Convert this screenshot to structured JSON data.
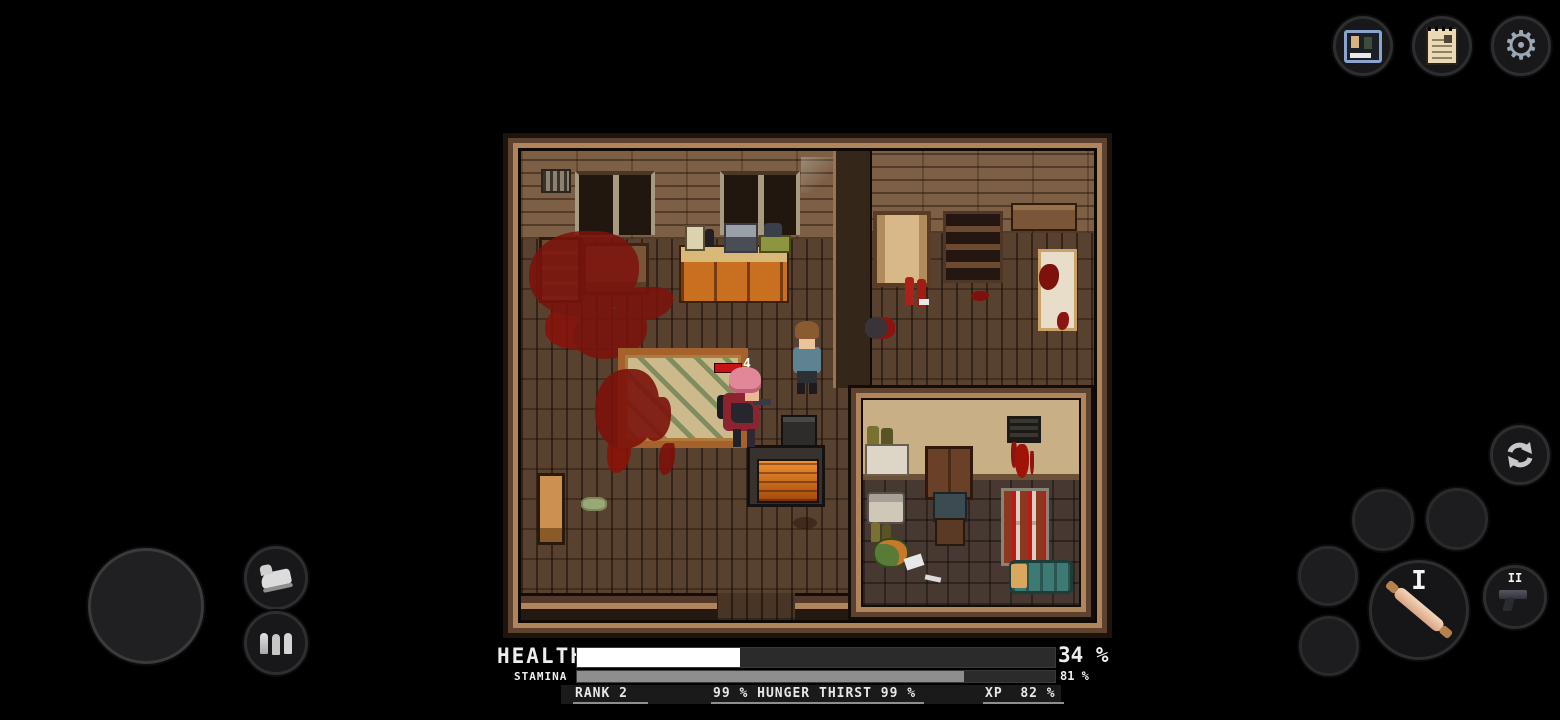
{
  "hud": {
    "health": {
      "label": "HEALTH",
      "pct": 34,
      "pct_text": "34 %",
      "fill_color": "#ffffff"
    },
    "stamina": {
      "label": "STAMINA",
      "pct": 81,
      "pct_text": "81 %",
      "fill_color": "#8e8e8e"
    },
    "stats": {
      "rank_label": "RANK",
      "rank_value": "2",
      "hunger_value": "99 %",
      "hunger_label": "HUNGER",
      "thirst_label": "THIRST",
      "thirst_value": "99 %",
      "xp_label": "XP",
      "xp_value": "82 %"
    }
  },
  "top_bar": {
    "buttons": [
      {
        "name": "survivor-card-button",
        "icon": "photo-card-icon"
      },
      {
        "name": "notes-button",
        "icon": "note-paper-icon"
      },
      {
        "name": "settings-button",
        "icon": "gear-icon",
        "glyph": "⚙"
      }
    ]
  },
  "controls": {
    "joystick": "movement-joystick",
    "sprint_icon": "sneaker-icon",
    "ammo_icon": "bullets-icon",
    "switch_icon": "swap-arrows-icon",
    "weapon_slots": [
      {
        "label": "I",
        "item": "rolling-pin"
      },
      {
        "label": "II",
        "item": "pistol"
      }
    ]
  },
  "game": {
    "enemy_damage_number": "4",
    "entities": [
      "player-pink-hair",
      "survivor-npc",
      "corpse",
      "rug",
      "wood-stove",
      "bookshelf",
      "table",
      "kitchen-counter",
      "wardrobe",
      "shelving-unit",
      "wall-shelf",
      "bed",
      "red-canisters",
      "inner-room",
      "sink",
      "door",
      "chair",
      "vent",
      "bottle-shelf",
      "teal-duffel-bag",
      "green-basket",
      "open-door",
      "blood-stains"
    ]
  },
  "colors": {
    "background": "#000000",
    "frame_light": "#b1855c",
    "frame_dark": "#1f140d",
    "wall": "#7d5f45",
    "floor": "#59412f",
    "blood": "#7c120b",
    "cabinet_orange": "#c87020",
    "rug_field": "#ccb98c",
    "rug_border": "#a5622c",
    "stove_glow": "#e5831f",
    "bag_teal": "#3d7a74",
    "enemy_bar_red": "#c41414"
  }
}
